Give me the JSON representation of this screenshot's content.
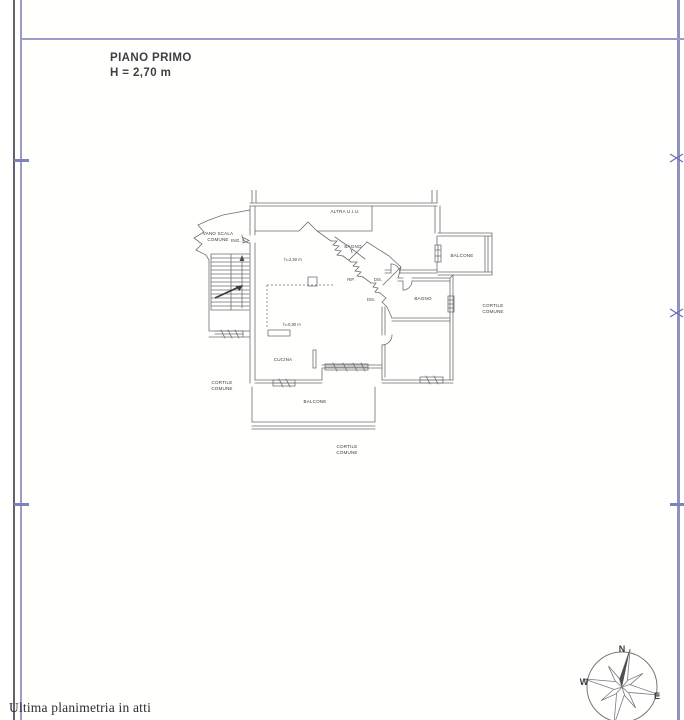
{
  "header": {
    "title": "PIANO PRIMO",
    "height_note": "H = 2,70 m"
  },
  "plan": {
    "labels": {
      "altra_uiu": "ALTRA U.I.U.",
      "vano_scala": [
        "VANO SCALA",
        "COMUNE"
      ],
      "ing": "ING.",
      "h_soffitto": "h=2,50 m",
      "h_muretto": "h=0,80 m",
      "bagno_top": "BAGNO",
      "balcone_right": "BALCONE",
      "rip": "RIP.",
      "dis_upper": "DIS.",
      "dis_lower": "DIS.",
      "bagno_right": "BAGNO",
      "cortile_right": [
        "CORTILE",
        "COMUNE"
      ],
      "cucina": "CUCINA",
      "cortile_left": [
        "CORTILE",
        "COMUNE"
      ],
      "balcone_bottom": "BALCONE",
      "cortile_bottom": [
        "CORTILE",
        "COMUNE"
      ]
    }
  },
  "compass": {
    "north": "N",
    "west": "W",
    "east": "E"
  },
  "footer": {
    "text": "Ultima planimetria in atti"
  },
  "colors": {
    "frame_blue": "#9a9dca",
    "frame_gray": "#63636a",
    "plan_line": "#6f6f72",
    "text": "#3d3d3f"
  }
}
